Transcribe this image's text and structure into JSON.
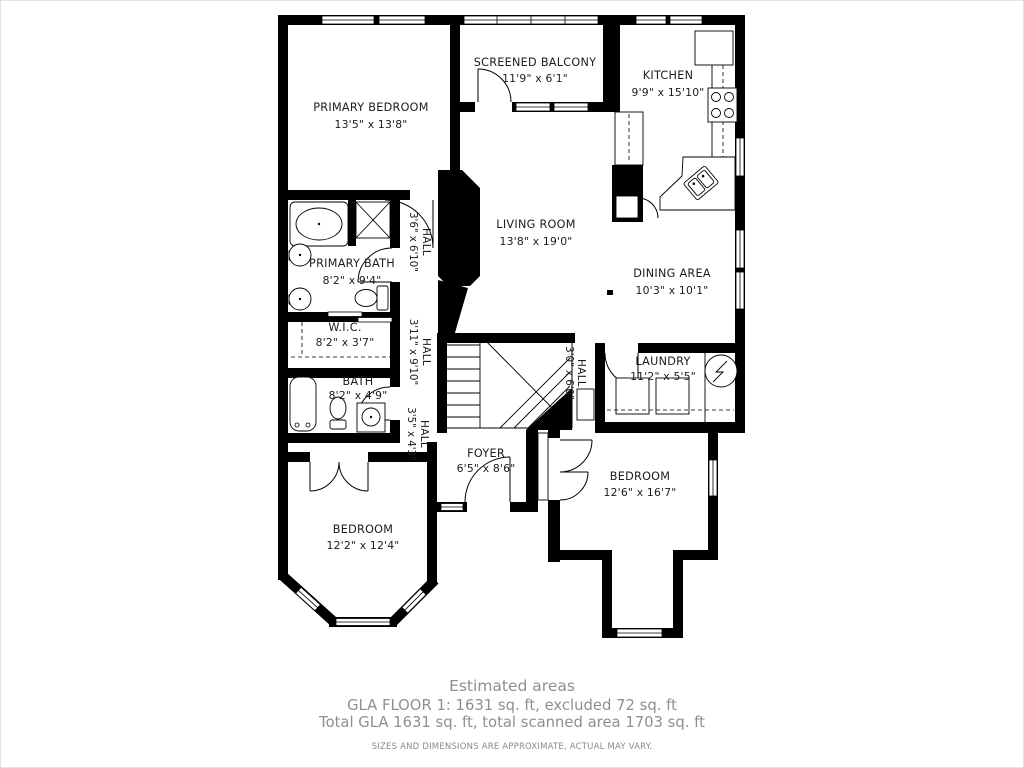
{
  "plan": {
    "rooms": {
      "primary_bedroom": {
        "name": "PRIMARY BEDROOM",
        "dims": "13'5\" x 13'8\""
      },
      "screened_balcony": {
        "name": "SCREENED BALCONY",
        "dims": "11'9\" x 6'1\""
      },
      "kitchen": {
        "name": "KITCHEN",
        "dims": "9'9\" x 15'10\""
      },
      "living_room": {
        "name": "LIVING ROOM",
        "dims": "13'8\" x 19'0\""
      },
      "dining_area": {
        "name": "DINING AREA",
        "dims": "10'3\" x 10'1\""
      },
      "primary_bath": {
        "name": "PRIMARY BATH",
        "dims": "8'2\" x 9'4\""
      },
      "wic": {
        "name": "W.I.C.",
        "dims": "8'2\" x 3'7\""
      },
      "bath": {
        "name": "BATH",
        "dims": "8'2\" x 4'9\""
      },
      "laundry": {
        "name": "LAUNDRY",
        "dims": "11'2\" x 5'5\""
      },
      "foyer": {
        "name": "FOYER",
        "dims": "6'5\" x 8'6\""
      },
      "bedroom_left": {
        "name": "BEDROOM",
        "dims": "12'2\" x 12'4\""
      },
      "bedroom_right": {
        "name": "BEDROOM",
        "dims": "12'6\" x 16'7\""
      }
    },
    "halls": {
      "hall1": {
        "name": "HALL",
        "dims": "3'6\" x 6'10\""
      },
      "hall2": {
        "name": "HALL",
        "dims": "3'11\" x 9'10\""
      },
      "hall3": {
        "name": "HALL",
        "dims": "3'5\" x 4'3\""
      },
      "hall4": {
        "name": "HALL",
        "dims": "3'0\" x 6'0\""
      }
    }
  },
  "footer": {
    "title": "Estimated areas",
    "line1": "GLA FLOOR 1: 1631 sq. ft, excluded 72 sq. ft",
    "line2": "Total GLA 1631 sq. ft, total scanned area 1703 sq. ft",
    "disclaimer": "SIZES AND DIMENSIONS ARE APPROXIMATE, ACTUAL MAY VARY."
  },
  "colors": {
    "wall": "#000000",
    "label": "#1b1b1b",
    "footer_text": "#8f8f8f"
  }
}
